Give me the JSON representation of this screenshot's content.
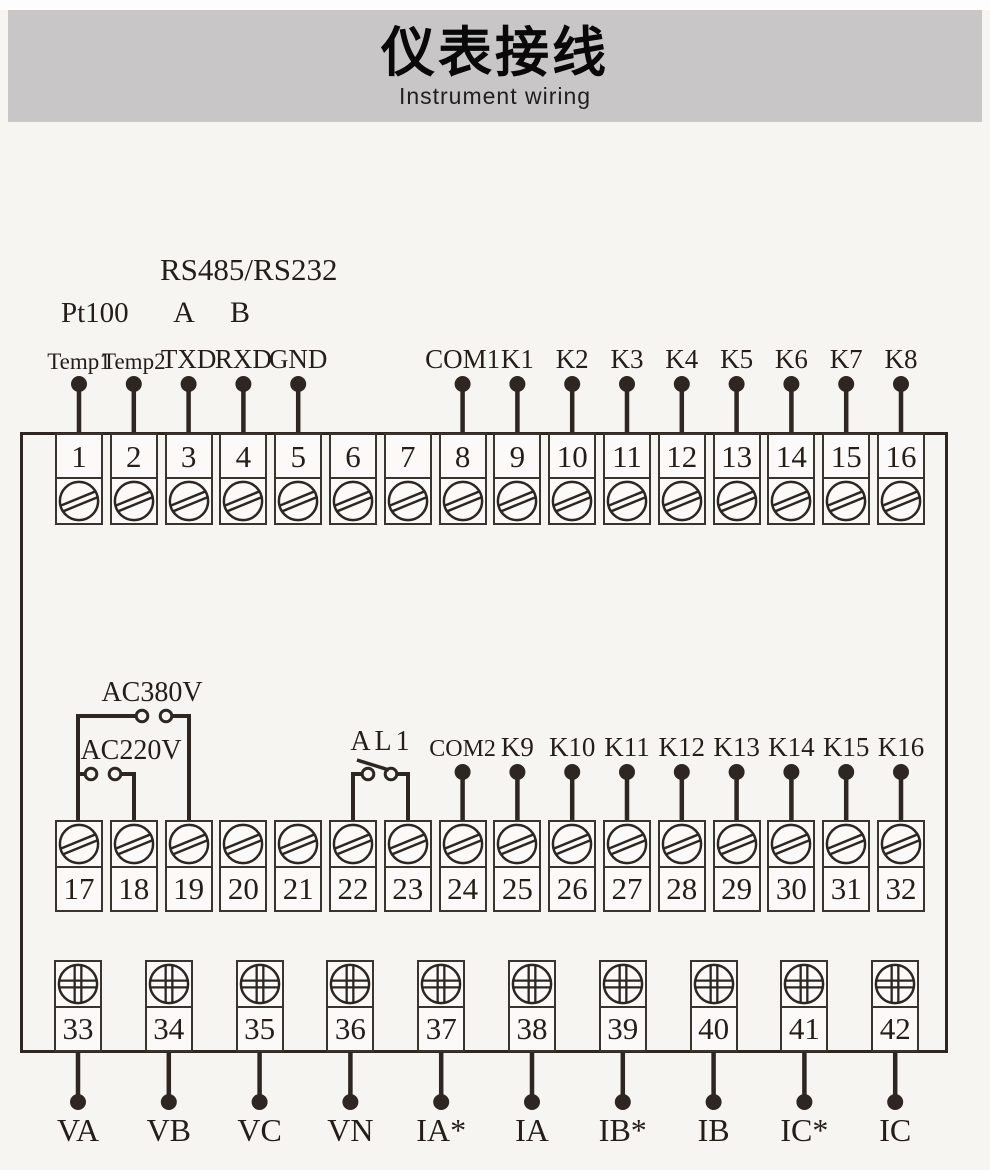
{
  "header": {
    "title": "仪表接线",
    "subtitle": "Instrument wiring"
  },
  "colors": {
    "header_bg": "#c8c6c6",
    "page_bg": "#f6f5f2",
    "line": "#2e2621",
    "box_border": "#3a342e",
    "box_bg": "#fbfaf8",
    "text": "#241d18"
  },
  "annotations": {
    "rs_label": "RS485/RS232",
    "pt_label": "Pt100",
    "a_label": "A",
    "b_label": "B",
    "ac380_label": "AC380V",
    "ac220_label": "AC220V",
    "al1_label": "AL1"
  },
  "rows": {
    "top": {
      "numbers": [
        "1",
        "2",
        "3",
        "4",
        "5",
        "6",
        "7",
        "8",
        "9",
        "10",
        "11",
        "12",
        "13",
        "14",
        "15",
        "16"
      ],
      "pins": [
        {
          "index": 0,
          "label": "Temp1"
        },
        {
          "index": 1,
          "label": "Temp2"
        },
        {
          "index": 2,
          "label": "TXD"
        },
        {
          "index": 3,
          "label": "RXD"
        },
        {
          "index": 4,
          "label": "GND"
        },
        {
          "index": 7,
          "label": "COM1"
        },
        {
          "index": 8,
          "label": "K1"
        },
        {
          "index": 9,
          "label": "K2"
        },
        {
          "index": 10,
          "label": "K3"
        },
        {
          "index": 11,
          "label": "K4"
        },
        {
          "index": 12,
          "label": "K5"
        },
        {
          "index": 13,
          "label": "K6"
        },
        {
          "index": 14,
          "label": "K7"
        },
        {
          "index": 15,
          "label": "K8"
        }
      ]
    },
    "middle": {
      "numbers": [
        "17",
        "18",
        "19",
        "20",
        "21",
        "22",
        "23",
        "24",
        "25",
        "26",
        "27",
        "28",
        "29",
        "30",
        "31",
        "32"
      ],
      "pins": [
        {
          "index": 7,
          "label": "COM2"
        },
        {
          "index": 8,
          "label": "K9"
        },
        {
          "index": 9,
          "label": "K10"
        },
        {
          "index": 10,
          "label": "K11"
        },
        {
          "index": 11,
          "label": "K12"
        },
        {
          "index": 12,
          "label": "K13"
        },
        {
          "index": 13,
          "label": "K14"
        },
        {
          "index": 14,
          "label": "K15"
        },
        {
          "index": 15,
          "label": "K16"
        }
      ]
    },
    "bottom": {
      "numbers": [
        "33",
        "34",
        "35",
        "36",
        "37",
        "38",
        "39",
        "40",
        "41",
        "42"
      ],
      "pins": [
        {
          "index": 0,
          "label": "VA"
        },
        {
          "index": 1,
          "label": "VB"
        },
        {
          "index": 2,
          "label": "VC"
        },
        {
          "index": 3,
          "label": "VN"
        },
        {
          "index": 4,
          "label": "IA*"
        },
        {
          "index": 5,
          "label": "IA"
        },
        {
          "index": 6,
          "label": "IB*"
        },
        {
          "index": 7,
          "label": "IB"
        },
        {
          "index": 8,
          "label": "IC*"
        },
        {
          "index": 9,
          "label": "IC"
        }
      ]
    }
  }
}
